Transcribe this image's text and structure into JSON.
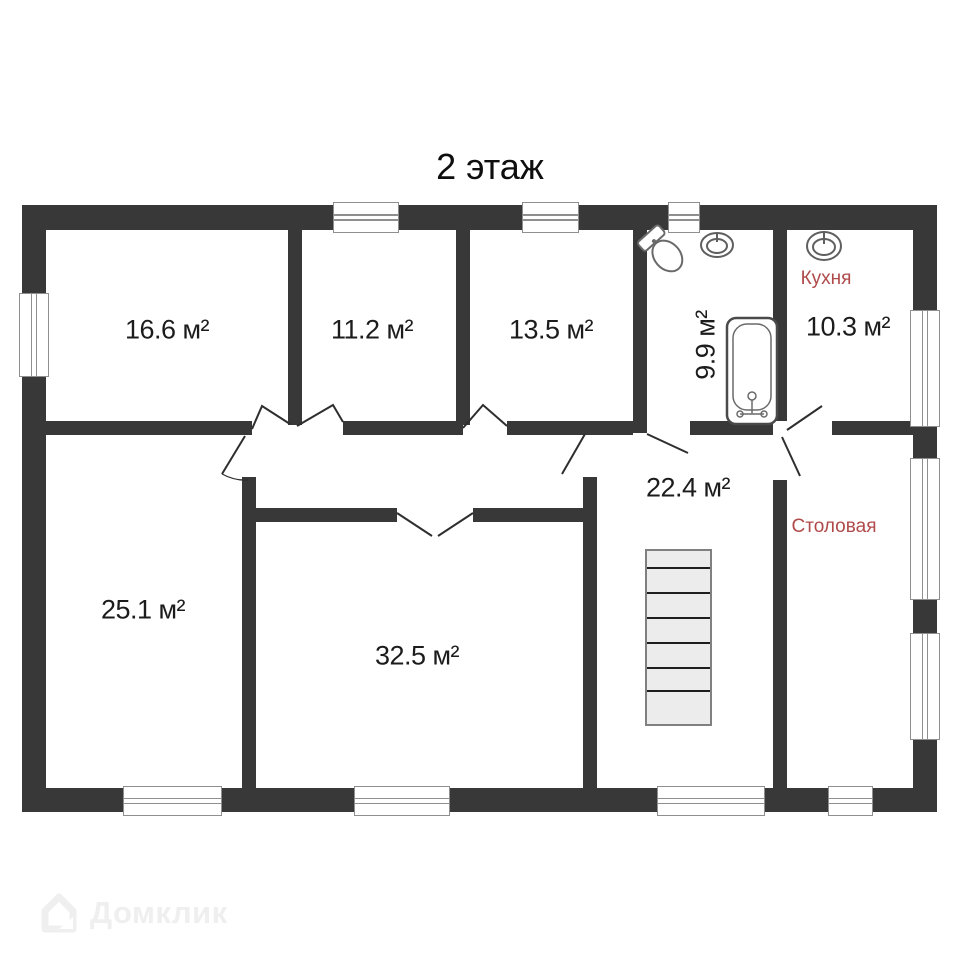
{
  "title": "2 этаж",
  "floor_plan": {
    "rooms": [
      {
        "name": "room-16-6",
        "area_label": "16.6 м²"
      },
      {
        "name": "room-11-2",
        "area_label": "11.2 м²"
      },
      {
        "name": "room-13-5",
        "area_label": "13.5 м²"
      },
      {
        "name": "bathroom",
        "area_label": "9.9 м²"
      },
      {
        "name": "kitchen",
        "area_label": "10.3 м²",
        "room_label": "Кухня"
      },
      {
        "name": "hall-stairs",
        "area_label": "22.4 м²"
      },
      {
        "name": "room-25-1",
        "area_label": "25.1 м²"
      },
      {
        "name": "room-32-5",
        "area_label": "32.5 м²"
      },
      {
        "name": "dining",
        "room_label": "Столовая"
      }
    ],
    "fixtures": [
      "toilet",
      "sink",
      "kitchen-sink",
      "bathtub",
      "staircase"
    ],
    "colors": {
      "wall": "#383838",
      "area_text": "#1c1c1c",
      "room_name_text": "#b04a4a",
      "stairs_fill": "#ececec",
      "watermark": "#efefef"
    }
  },
  "watermark": {
    "text": "Домклик"
  }
}
